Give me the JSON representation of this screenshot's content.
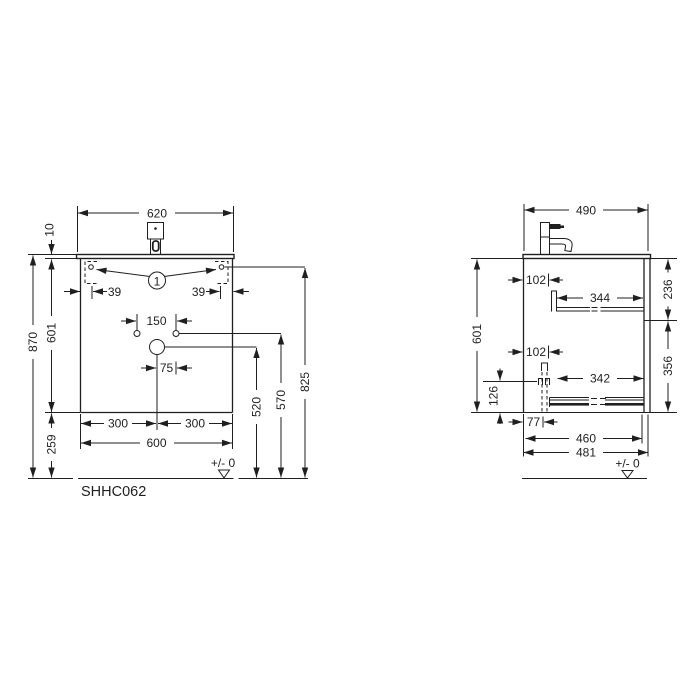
{
  "model_code": "SHHC062",
  "front_view": {
    "balloon_label": "1",
    "datum_label": "+/- 0",
    "dims": {
      "top_width": "620",
      "countertop_thickness": "10",
      "total_height": "870",
      "carcass_height": "601",
      "plinth_clearance": "259",
      "fixing_offset_left": "39",
      "fixing_offset_right": "39",
      "hole_spacing": "150",
      "drain_to_hole": "75",
      "half_width_left": "300",
      "half_width_right": "300",
      "carcass_width": "600",
      "drain_height": "520",
      "holes_height": "570",
      "fixing_height": "825"
    }
  },
  "side_view": {
    "datum_label": "+/- 0",
    "dims": {
      "top_depth": "490",
      "upper_rail_setback": "102",
      "upper_rail_length": "344",
      "upper_section_height": "236",
      "carcass_height": "601",
      "lower_rail_setback": "102",
      "lower_rail_length": "342",
      "lower_section_height": "356",
      "lower_rail_height": "126",
      "trap_setback": "77",
      "inner_depth": "460",
      "total_depth": "481"
    }
  }
}
